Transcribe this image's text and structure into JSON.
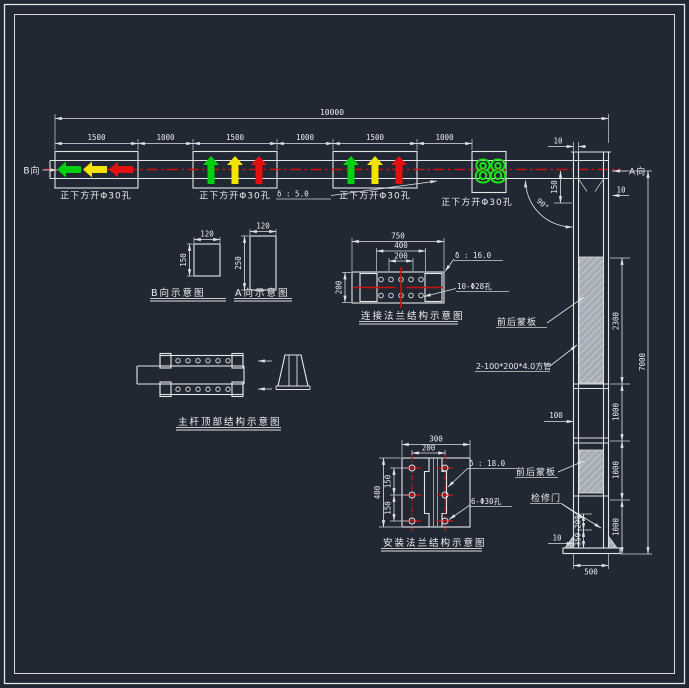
{
  "drawing": {
    "beam": {
      "total_dim": "10000",
      "seg_dims": [
        "1500",
        "1000",
        "1500",
        "1000",
        "1500",
        "1000"
      ],
      "hole_note": "正下方开Φ30孔",
      "view_b_label": "B向",
      "view_a_label": "A向",
      "plate_thickness_note": "δ : 5.0",
      "countdown_display": "88"
    },
    "pole": {
      "top_wall_dim": "10",
      "drop_dim": "150",
      "right_wall_dim": "10",
      "angle_dim": "90°",
      "offset_dim": "100",
      "panel_span_dim": "2300",
      "seg_dim": "1000",
      "total_height_dim": "7000",
      "base_width_dim": "500",
      "base_wall_dim": "10",
      "door_height_dim": "350",
      "door_offset_dim": "200",
      "panel_label_upper": "前后蒙板",
      "tube_label": "2-100*200*4.0方管",
      "panel_label_lower": "前后蒙板",
      "door_label": "检修门"
    },
    "detail_b_view": {
      "title": "B向示意图",
      "width_dim": "120",
      "height_dim": "150"
    },
    "detail_a_view": {
      "title": "A向示意图",
      "width_dim": "120",
      "height_dim": "250"
    },
    "detail_conn_flange": {
      "title": "连接法兰结构示意图",
      "width_dim": "750",
      "bolt_span_dim": "400",
      "bolt_pitch_dim": "200",
      "height_dim": "200",
      "thickness_note": "δ : 16.0",
      "holes_note": "10-Φ28孔"
    },
    "detail_pole_top": {
      "title": "主杆顶部结构示意图"
    },
    "detail_install_flange": {
      "title": "安装法兰结构示意图",
      "width_dim": "300",
      "bolt_span_dim": "200",
      "height_dim": "400",
      "pitch_dim_upper": "150",
      "pitch_dim_lower": "150",
      "thickness_note": "δ : 18.0",
      "holes_note": "6-Φ30孔"
    }
  },
  "colors": {
    "background": "#212833",
    "linework": "#e3e6e9",
    "centerline_red": "#d01010",
    "arrow_green": "#00cf12",
    "arrow_yellow": "#f2e400",
    "arrow_red": "#e31111",
    "countdown_green": "#1ce31c",
    "hatch_gray": "#a7adb4"
  }
}
